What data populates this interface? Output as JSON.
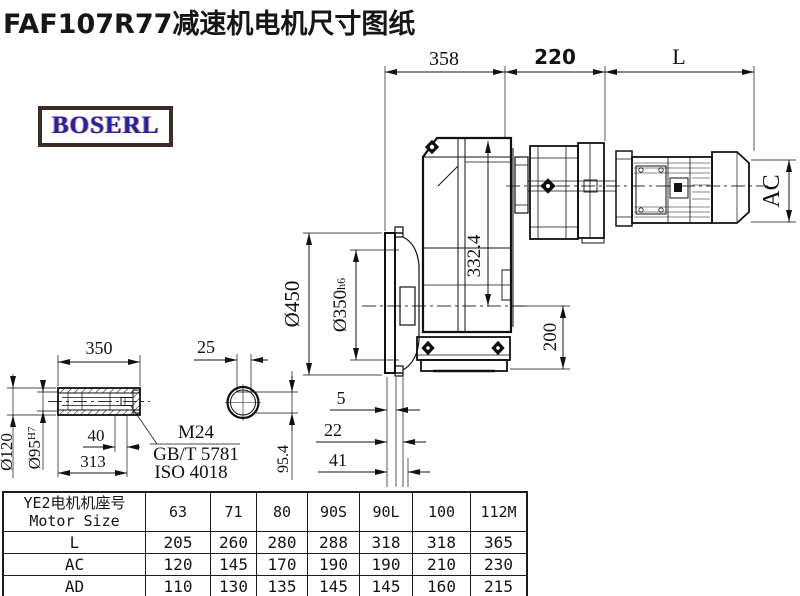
{
  "title": "FAF107R77减速机电机尺寸图纸",
  "logo": {
    "text": "BOSERL"
  },
  "drawing": {
    "top_dims": {
      "gearbox_width": "358",
      "adapter_length": "220",
      "motor_length": "L"
    },
    "motor": {
      "outer_diameter_label": "AC"
    },
    "flange": {
      "outer_diameter": "Ø450",
      "spigot_diameter": "Ø350",
      "spigot_tolerance": "h6"
    },
    "vertical_dims": {
      "center_height": "332.4",
      "axis_to_base": "200"
    },
    "face_offsets": {
      "small": "5",
      "mid": "22",
      "large": "41",
      "key_line_height": "95.4"
    },
    "shaft": {
      "length": "350",
      "key_width": "25",
      "retain_depth": "40",
      "bore_length": "313",
      "outer_diameter": "Ø120",
      "bore_diameter": "Ø95",
      "bore_tolerance": "H7",
      "thread": "M24",
      "standard_gb": "GB/T 5781",
      "standard_iso": "ISO 4018"
    }
  },
  "table": {
    "header": {
      "line1": "YE2电机机座号",
      "line2": "Motor Size"
    },
    "columns": [
      "63",
      "71",
      "80",
      "90S",
      "90L",
      "100",
      "112M"
    ],
    "rows": [
      {
        "label": "L",
        "values": [
          "205",
          "260",
          "280",
          "288",
          "318",
          "318",
          "365"
        ]
      },
      {
        "label": "AC",
        "values": [
          "120",
          "145",
          "170",
          "190",
          "190",
          "210",
          "230"
        ]
      },
      {
        "label": "AD",
        "values": [
          "110",
          "130",
          "135",
          "145",
          "145",
          "160",
          "215"
        ]
      }
    ]
  }
}
